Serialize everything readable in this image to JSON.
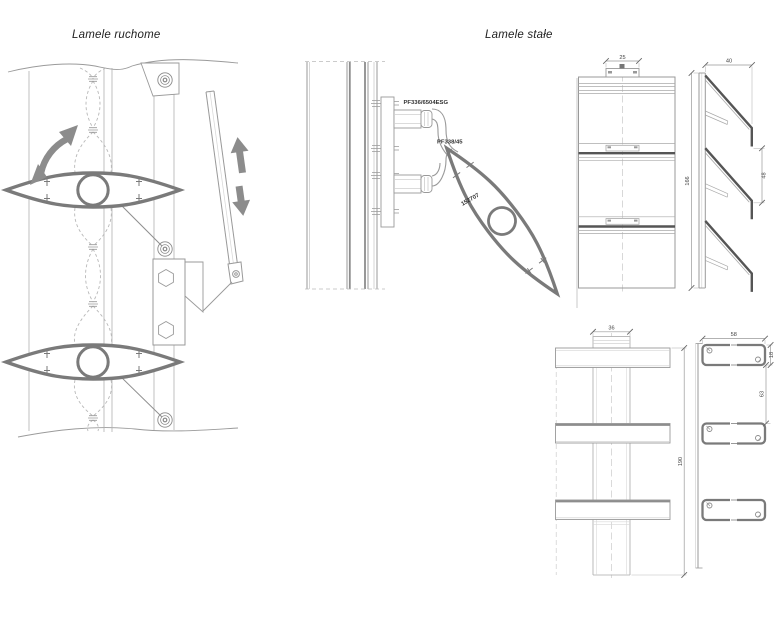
{
  "titles": {
    "movable": "Lamele ruchome",
    "fixed": "Lamele stałe"
  },
  "part_labels": {
    "profile_top": "PF336/6504ESG",
    "profile_mid": "PF338/45",
    "blade_number": "152707"
  },
  "dimensions": {
    "front_tab_width": "25",
    "side_depth": "40",
    "side_height": "166",
    "side_blade_gap": "48",
    "bottom_post_width": "36",
    "bottom_height": "190",
    "bottom_bar_width": "58",
    "bottom_bar_height": "18",
    "bottom_bar_gap": "63"
  },
  "colors": {
    "thin_line": "#9a9a9a",
    "dark_line": "#555555",
    "blade_outline": "#7a7a7a",
    "arrow_fill": "#8c8c8c",
    "dashed_line": "#b8b8b8",
    "label_text": "#333333"
  }
}
